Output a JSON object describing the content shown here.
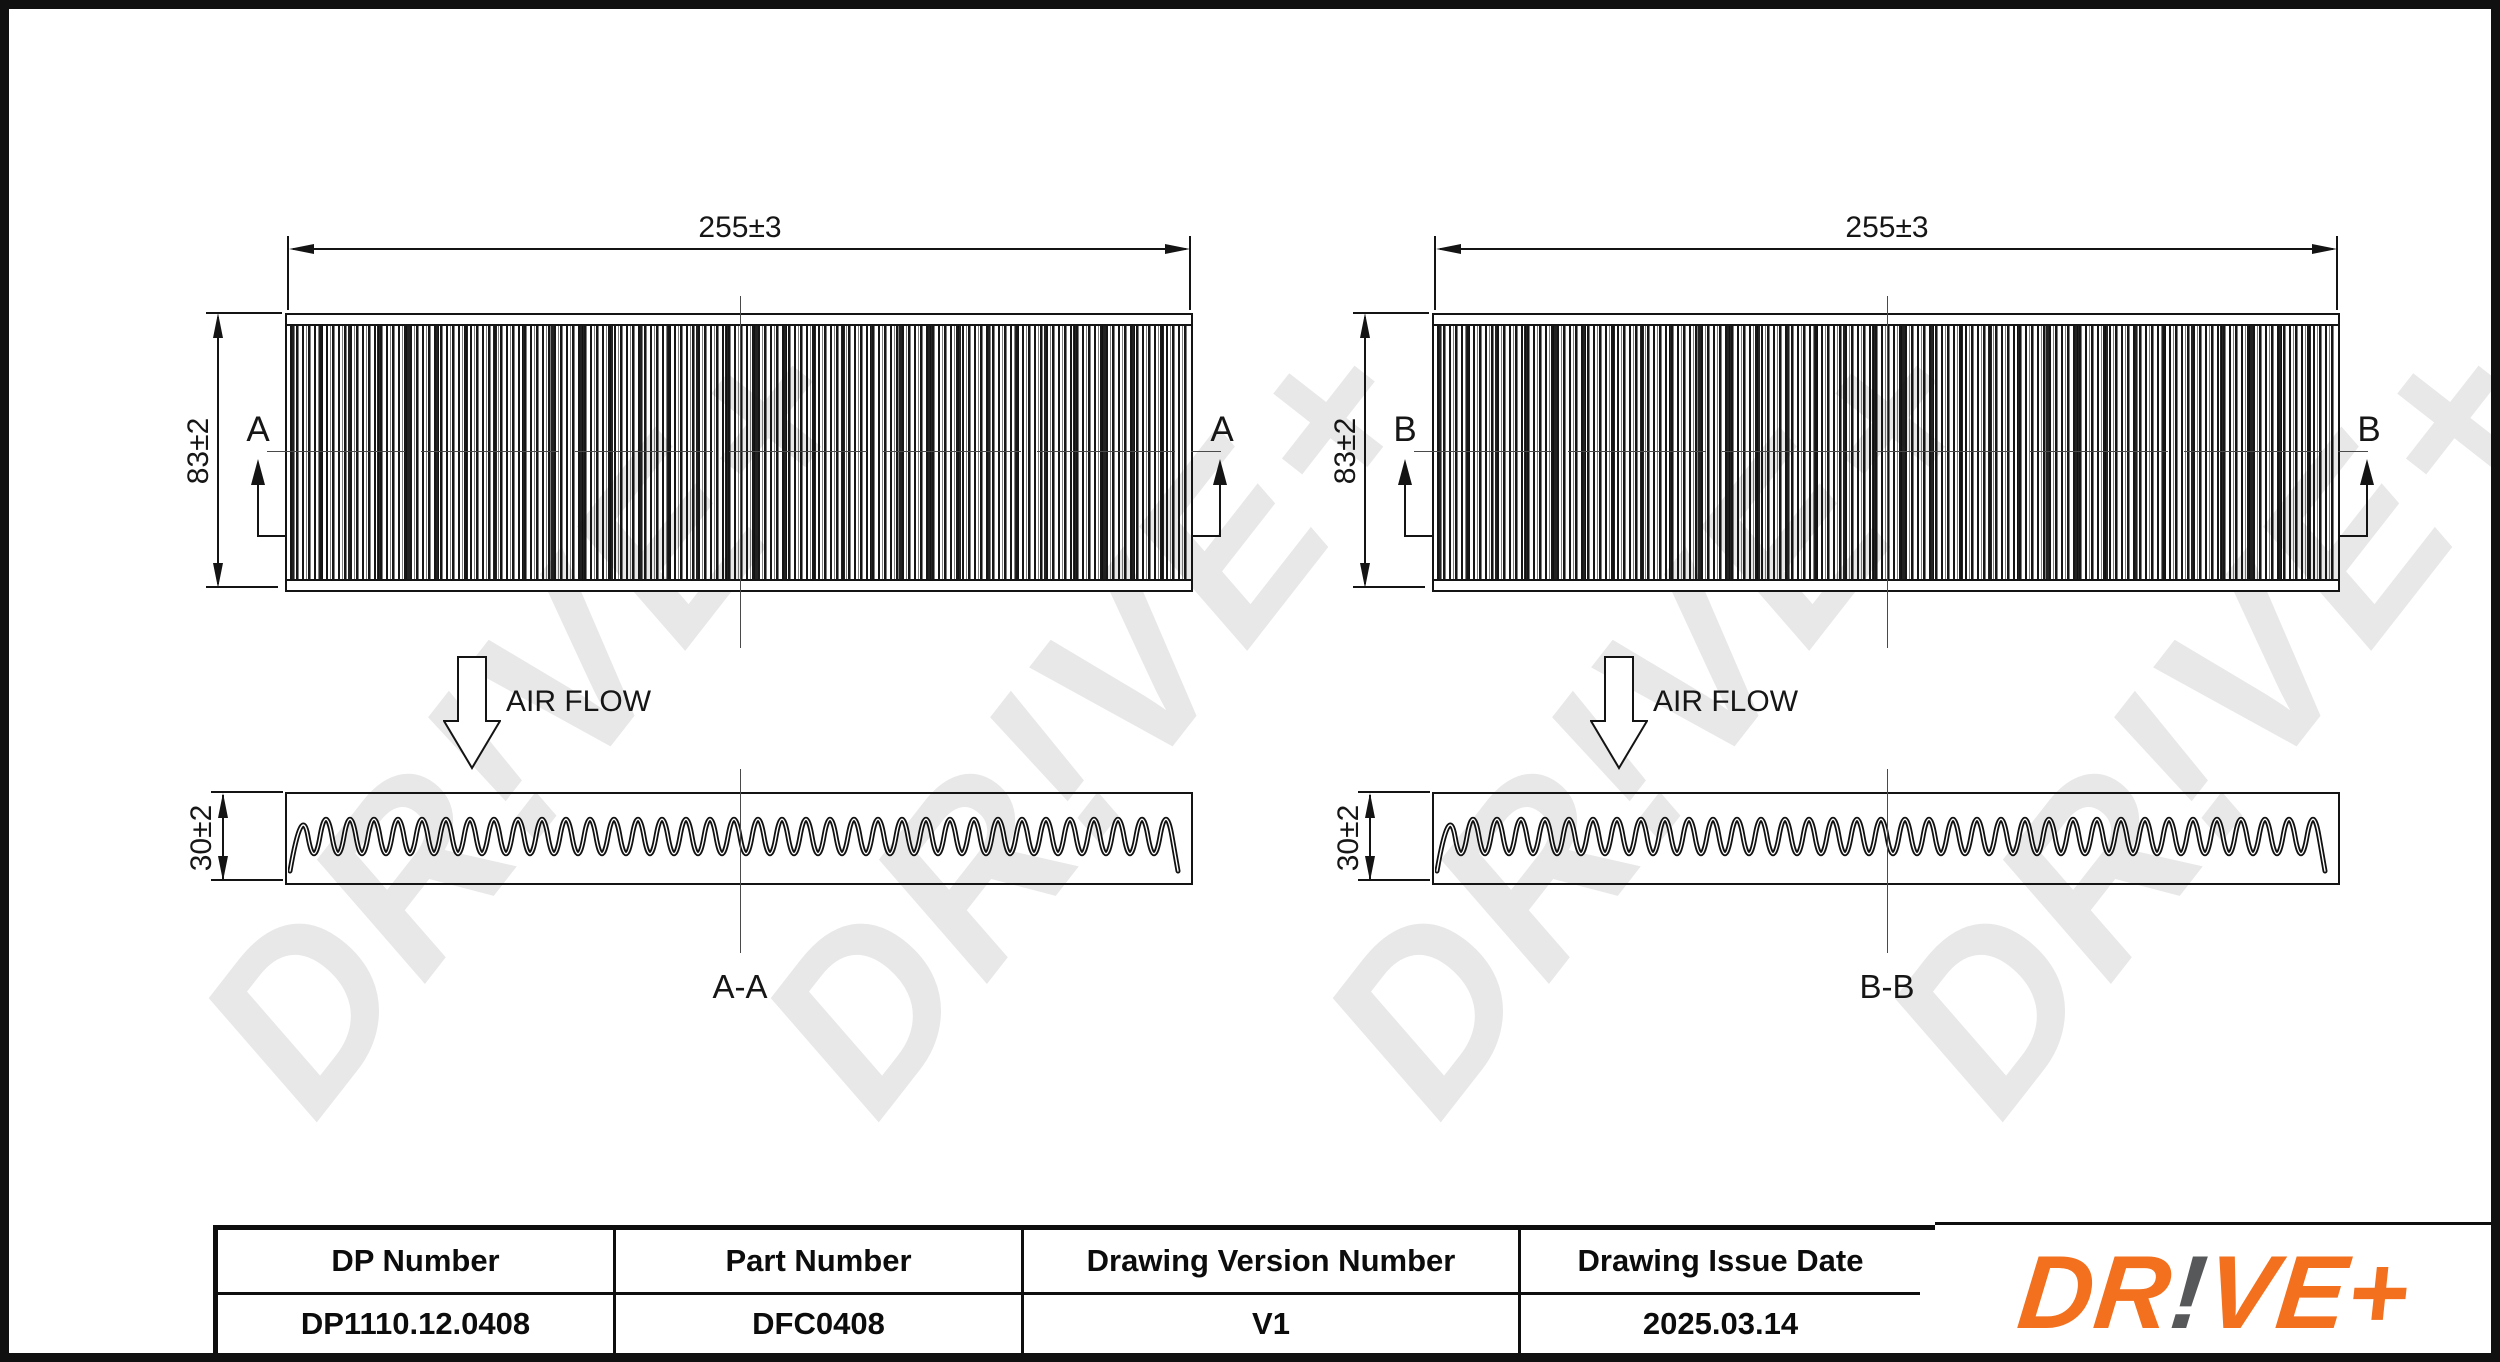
{
  "sheet": {
    "type": "technical-drawing",
    "line_color": "#141414",
    "watermark_text": "DR!VE+",
    "logo_orange": "#F2701E",
    "logo_grey": "#57585A"
  },
  "views": [
    {
      "width_dim": "255±3",
      "height_dim": "83±2",
      "depth_dim": "30±2",
      "section_letter_left": "A",
      "section_letter_right": "A",
      "airflow_label": "AIR FLOW",
      "section_name": "A-A"
    },
    {
      "width_dim": "255±3",
      "height_dim": "83±2",
      "depth_dim": "30±2",
      "section_letter_left": "B",
      "section_letter_right": "B",
      "airflow_label": "AIR FLOW",
      "section_name": "B-B"
    }
  ],
  "title_block": {
    "columns": [
      {
        "header": "DP Number",
        "value": "DP1110.12.0408"
      },
      {
        "header": "Part Number",
        "value": "DFC0408"
      },
      {
        "header": "Drawing Version Number",
        "value": "V1"
      },
      {
        "header": "Drawing Issue Date",
        "value": "2025.03.14"
      }
    ]
  },
  "logo": {
    "part1": "DR",
    "bang": "!",
    "part2": "VE+"
  }
}
